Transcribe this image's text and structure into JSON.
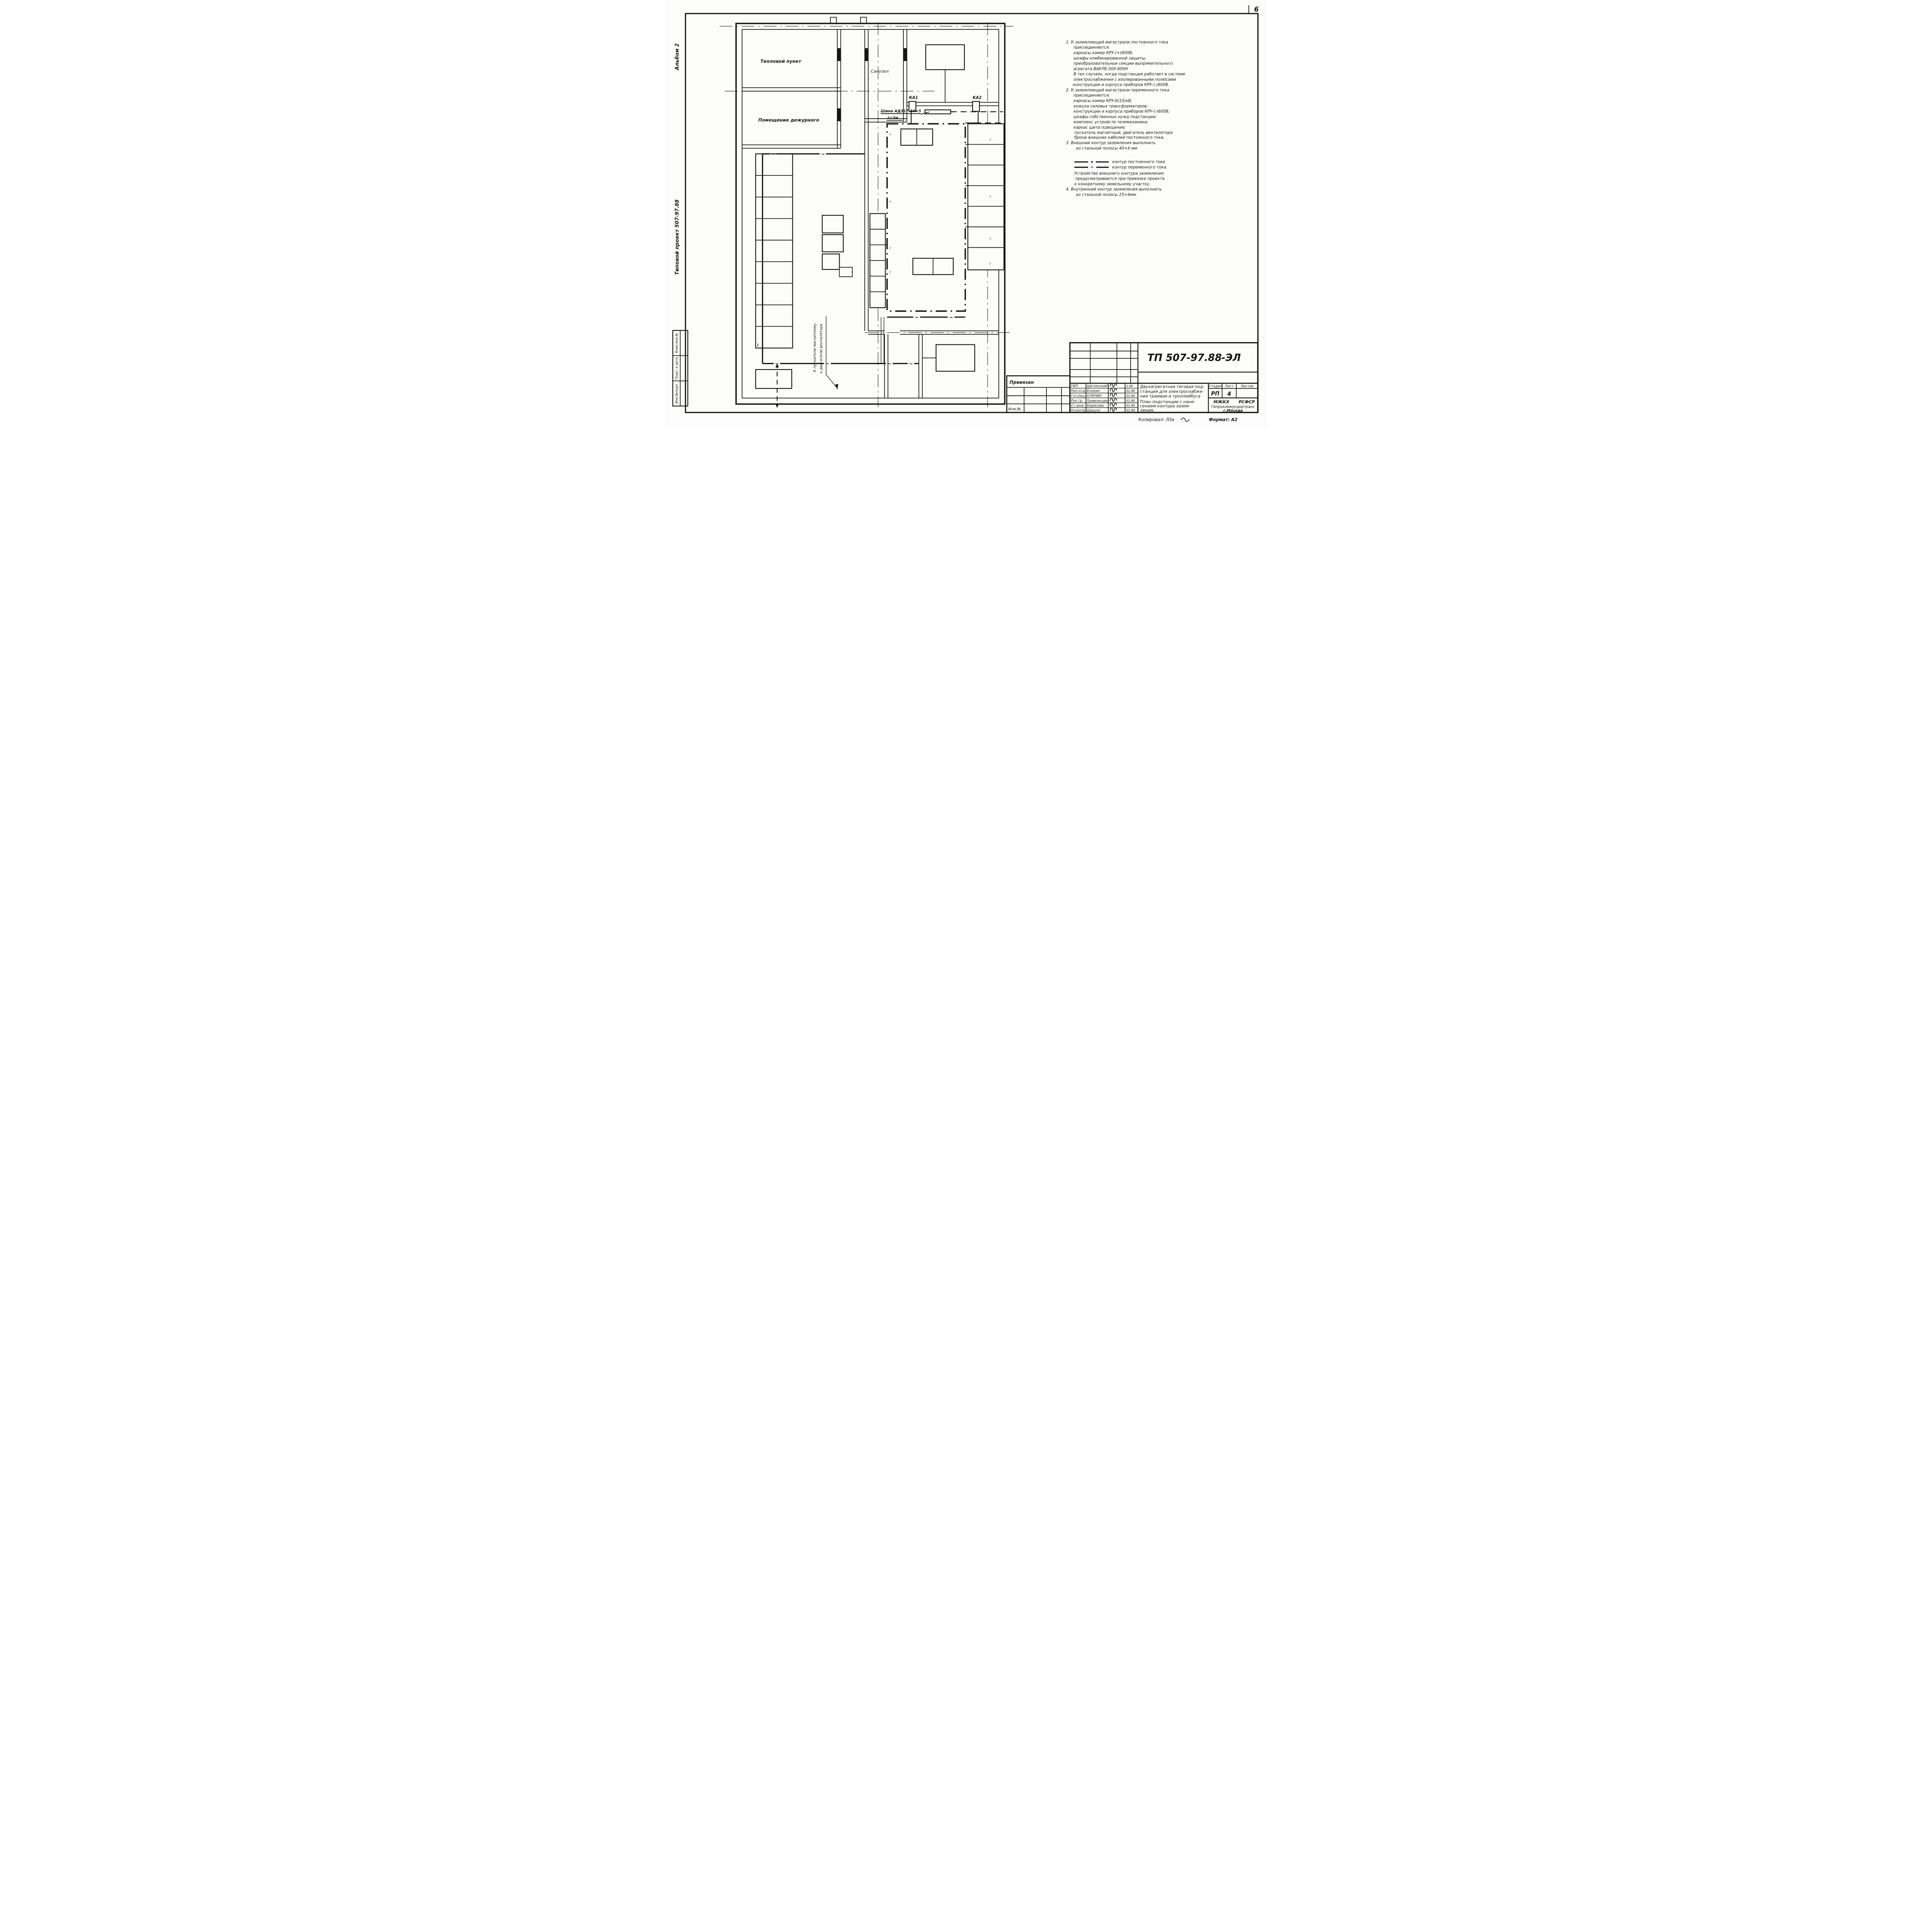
{
  "page": {
    "sheet_corner_number": "6",
    "copied_by": "Копировал: ЛЗа",
    "format_note": "Формат: А2",
    "ink_color": "#161616",
    "paper_color": "#fcfcfa"
  },
  "margin_left": {
    "album": "Альбом 2",
    "project": "Типовой   проект 507-97.88",
    "stamps": [
      "Инв.№подл.",
      "Подп. и дата",
      "Взам.инв.№"
    ]
  },
  "plan": {
    "rooms": {
      "heat_point": "Тепловой пункт",
      "bathroom": "Санузел",
      "duty_room": "Помещение дежурного"
    },
    "labels": {
      "ka1": "КА1",
      "ka2": "КА2",
      "bus": "Шина АД31Т-50×5",
      "bus_length": "ℓ=3м",
      "fan_line1": "К пускателю магнитному,",
      "fan_line2": "к двигателю вентилятора"
    },
    "marks": {
      "ground": "г",
      "ac": "~"
    }
  },
  "notes": {
    "lines": [
      "1. К заземляющей магистрали постоянного тока",
      "присоединяются:",
      "каркасы камер КРУ-(+)600В;",
      "шкафы комбинированной защиты;",
      "преобразовательные секции выпрямительного",
      "агрегата   ВАКЛЕ-000-600Н",
      "В тех случаях, когда подстанция работает в системе",
      "электроснабжения с изолированными полюсами",
      "-конструкции и корпуса приборов КРУ-(-)600В.",
      "2. К заземляющей магистрали переменного тока",
      "присоединяются:",
      "каркасы камер КРУ-6(10)кВ;",
      "кожуха силовых трансформаторов;",
      "конструкции и корпуса приборов КРУ-(-)600В;",
      "шкафы собственных нужд подстанции;",
      "комплекс устройств телемеханики;",
      "каркас щита освещения;",
      "пускатель магнитный; двигатель вентилятора",
      "брони внешних кабелей постоянного тока.",
      "3. Внешний контур заземления выполнить",
      "из стальной полосы 40×4 мм",
      "Устройство внешнего контура заземления",
      "предусматривается при привязке проекта",
      "к конкретному земельному участку.",
      "4. Внутренний контур заземления выполнить",
      "из стальной полосы 25×4мм."
    ]
  },
  "legend": {
    "dc": "контур постоянного тока",
    "ac": "контур переменного тока."
  },
  "titleblock": {
    "doc_number": "ТП 507-97.88",
    "doc_suffix": "-ЭЛ",
    "attached": "Привязан",
    "inventory": "Инв.№",
    "rows": [
      {
        "role": "ГИП",
        "name": "Щетинский",
        "date": "2.88"
      },
      {
        "role": "Нач.отд",
        "name": "Блохин",
        "date": "02.88"
      },
      {
        "role": "Гл.спец.",
        "name": "КЛЯЧИН",
        "date": "02.88"
      },
      {
        "role": "Рук.гр.",
        "name": "Привезенцева",
        "date": "02.88"
      },
      {
        "role": "Ст.инж.",
        "name": "Борисова",
        "date": "02.88"
      },
      {
        "role": "Н.контр.",
        "name": "Шишло",
        "date": "02.88"
      }
    ],
    "title_lines": [
      "Двухагрегатная тяговая под-",
      "станция для электроснабже-",
      "ния трамвая и троллейбуса"
    ],
    "subtitle_lines": [
      "План подстанции с нане-",
      "сением контура зазем-",
      "ления."
    ],
    "stage_label": "Стадия",
    "sheet_label": "Лист",
    "sheets_label": "Листов",
    "stage": "РП",
    "sheet": "4",
    "org_line1a": "МЖКХ",
    "org_line1b": "РСФСР",
    "org_line2": "Гипрокоммундортранс",
    "org_line3": "г.Москва"
  }
}
